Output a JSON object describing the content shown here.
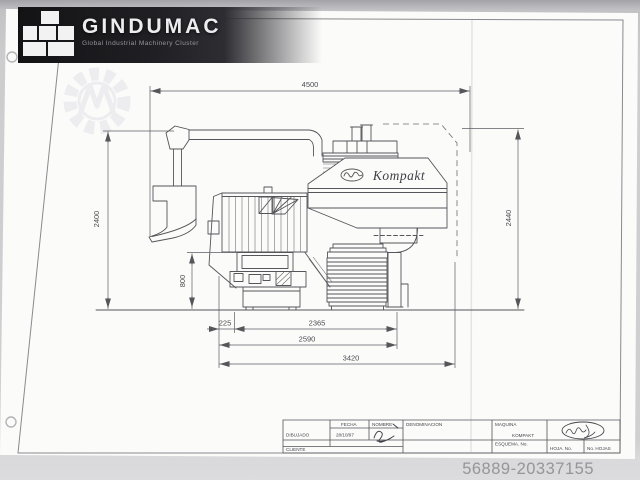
{
  "branding": {
    "logo_text": "GINDUMAC",
    "tagline": "Global Industrial Machinery Cluster"
  },
  "listing": {
    "id": "56889-20337155"
  },
  "drawing": {
    "machine_label": "Kompakt",
    "dimensions": {
      "top_width": "4500",
      "left_height": "2400",
      "right_height": "2440",
      "door_height": "800",
      "offset_left": "225",
      "chamber_width": "2365",
      "body_width": "2590",
      "overall_length": "3420"
    },
    "title_block": {
      "dibujado": "DIBUJADO",
      "cliente": "CLIENTE",
      "fecha": "FECHA",
      "fecha_value": "28/10/97",
      "nombre": "NOMBRE",
      "denominacion": "DENOMINACION",
      "maquina": "MAQUINA",
      "maquina_value": "KOMPAKT",
      "esquema": "ESQUEMA. No.",
      "hoja": "HOJA. No.",
      "hojas": "No. HOJAS"
    }
  }
}
